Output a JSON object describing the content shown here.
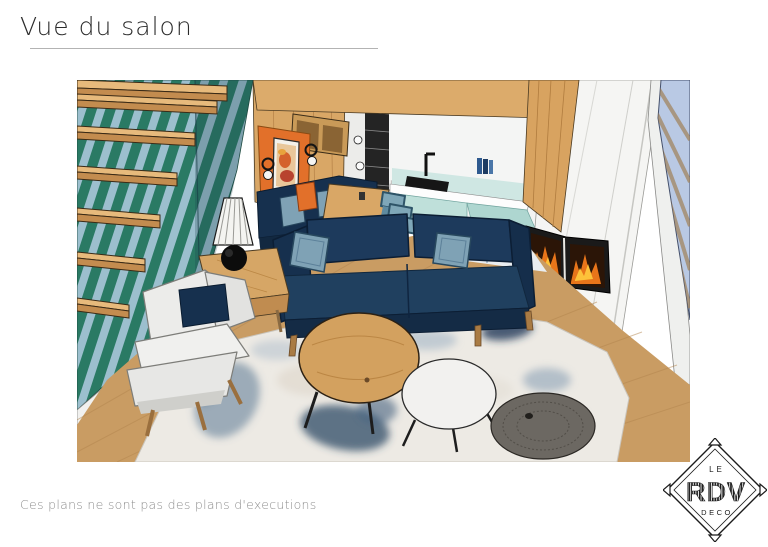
{
  "page": {
    "title": "Vue du salon",
    "footer_note": "Ces plans ne sont pas des plans d'executions",
    "background": "#ffffff",
    "title_color": "#2b2b2b",
    "footer_color": "#8f8f8f"
  },
  "logo": {
    "top": "LE",
    "middle": "RDV",
    "bottom": "DECO"
  },
  "scene": {
    "label": "Rendu 3D du salon",
    "colors": {
      "stripe_green": "#2a7a64",
      "stripe_blue": "#9cbfce",
      "wood_wall": "#d9a766",
      "wood_beam": "#dcab6b",
      "wood_floor": "#c99c63",
      "wood_step_top": "#e7ba7c",
      "wood_step_front": "#c38c4f",
      "orange_accent": "#e2702a",
      "navy_sofa": "#1d3a5c",
      "navy_dark": "#16304e",
      "pillow_blue": "#7fa2b5",
      "kitchen_mint": "#bfe0da",
      "fireplace_white": "#f5f5f3",
      "flame_orange": "#e8751a",
      "flame_yellow": "#fdc23a",
      "window_blue": "#b9c9e4",
      "rug_base": "#edeae4",
      "rug_blue": "#2e4a66",
      "pouf_gray": "#6c6862",
      "armchair_white": "#ececea"
    }
  }
}
